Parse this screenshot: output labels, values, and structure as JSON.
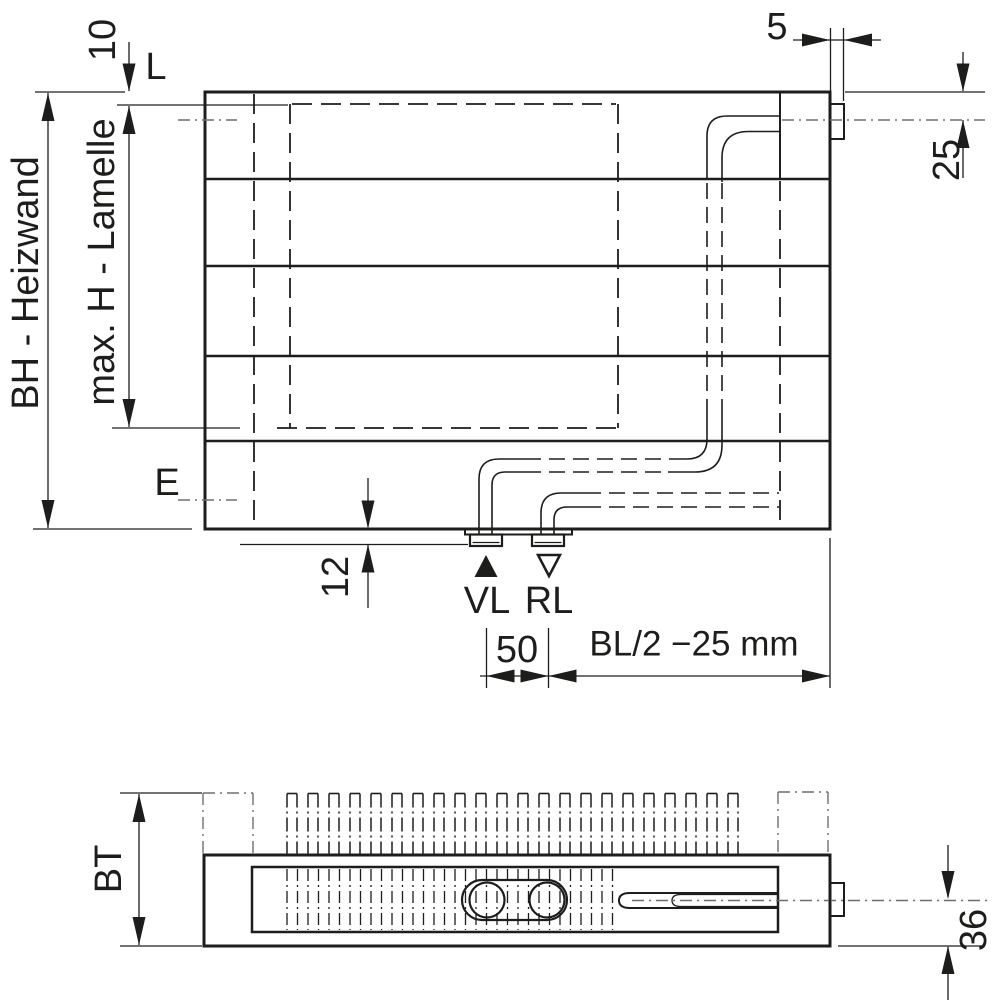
{
  "title": "Heizwand Anschlussmasse technische Zeichnung",
  "front_view": {
    "height_label": "BH - Heizwand",
    "lamelle_height_label": "max. H - Lamelle",
    "top_offset": "10",
    "side_connection_label": "L",
    "stub_width": "5",
    "side_connection_offset": "25",
    "drain_label": "E",
    "bottom_stub_height": "12",
    "supply_label": "VL",
    "return_label": "RL",
    "port_spacing": "50",
    "port_position": "BL/2 −25 mm"
  },
  "plan_view": {
    "depth_label": "BT",
    "centerline_offset": "36"
  },
  "colors": {
    "line": "#1d1d1b",
    "centerline": "#6e6e6e",
    "background": "#ffffff"
  },
  "geometry": {
    "fins": {
      "start_x": 287,
      "pitch": 21,
      "width": 10,
      "count": 22,
      "top_y": 793.5,
      "bottom_y": 854
    },
    "hatch": {
      "start_x": 287,
      "pitch": 10.5,
      "end_x": 614,
      "top_y": 869,
      "bottom_y": 930
    }
  }
}
